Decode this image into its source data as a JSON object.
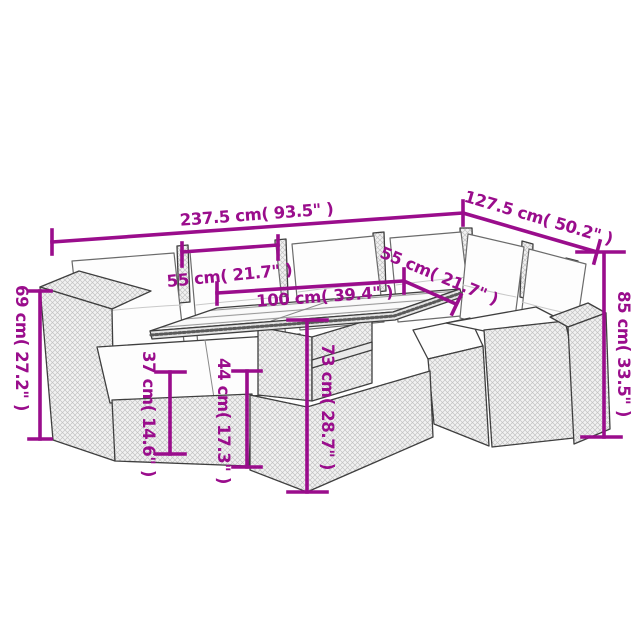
{
  "diagram": {
    "background_color": "#ffffff",
    "dimension_color": "#9A0D8C",
    "labels": {
      "total_width": "237.5 cm( 93.5\" )",
      "total_depth": "127.5 cm( 50.2\" )",
      "left_seat_width": "55 cm( 21.7\" )",
      "right_seat_width": "55 cm( 21.7\" )",
      "table_length": "100 cm( 39.4\" )",
      "backrest_height": "85 cm( 33.5\" )",
      "armrest_height": "69 cm( 27.2\" )",
      "seat_height": "37 cm( 14.6\" )",
      "seat_to_tabletop_height": "44 cm( 17.3\" )",
      "table_height": "73 cm( 28.7\" )"
    }
  }
}
